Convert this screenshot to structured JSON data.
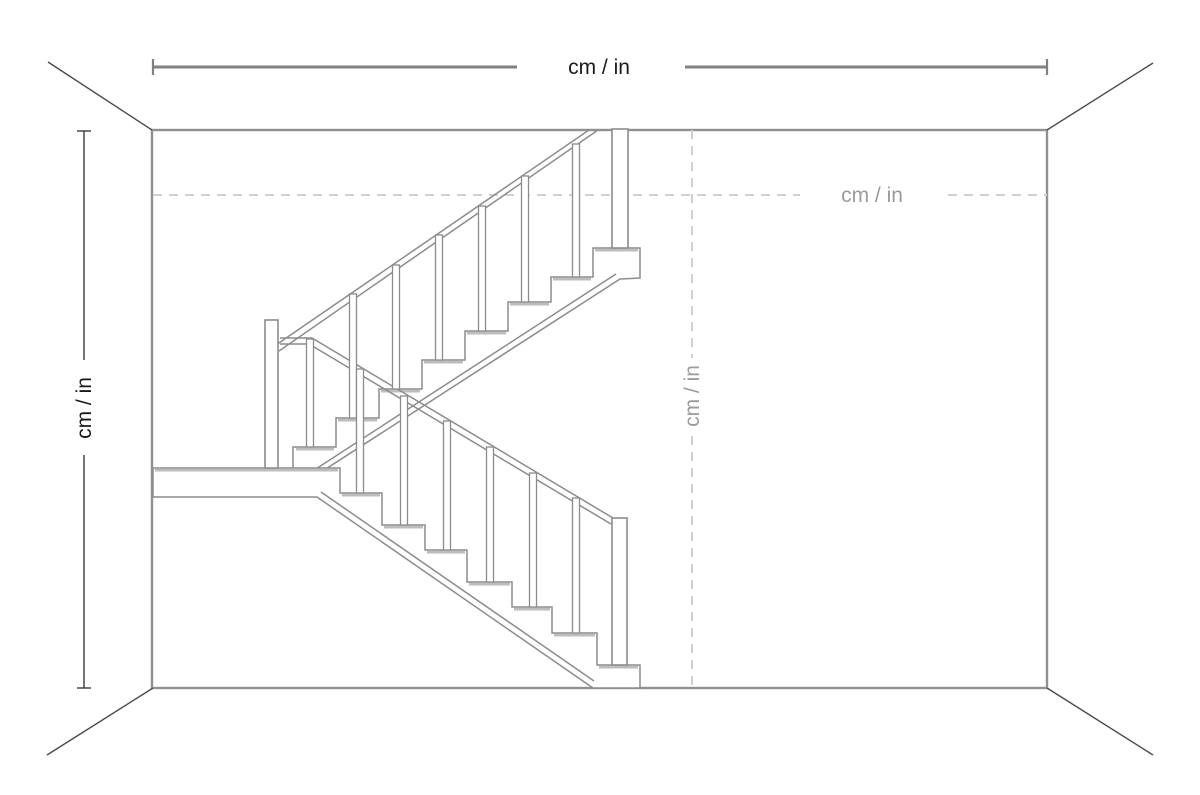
{
  "diagram": {
    "labels": {
      "room_width": "cm / in",
      "room_height": "cm / in",
      "guide_horizontal": "cm / in",
      "guide_vertical": "cm / in"
    },
    "colors": {
      "background": "#ffffff",
      "wall_line": "#919191",
      "corner_line": "#4a4a4a",
      "dimension_line": "#808080",
      "dimension_tick": "#808080",
      "height_dimension_line": "#3a3a3a",
      "dimension_text": "#1a1a1a",
      "dashed_guide_line": "#d0d0d0",
      "guide_text": "#9b9b9b",
      "stair_outline": "#8c8c8c",
      "stair_fill": "#ffffff",
      "tread_highlight": "#bdbdbd"
    }
  }
}
